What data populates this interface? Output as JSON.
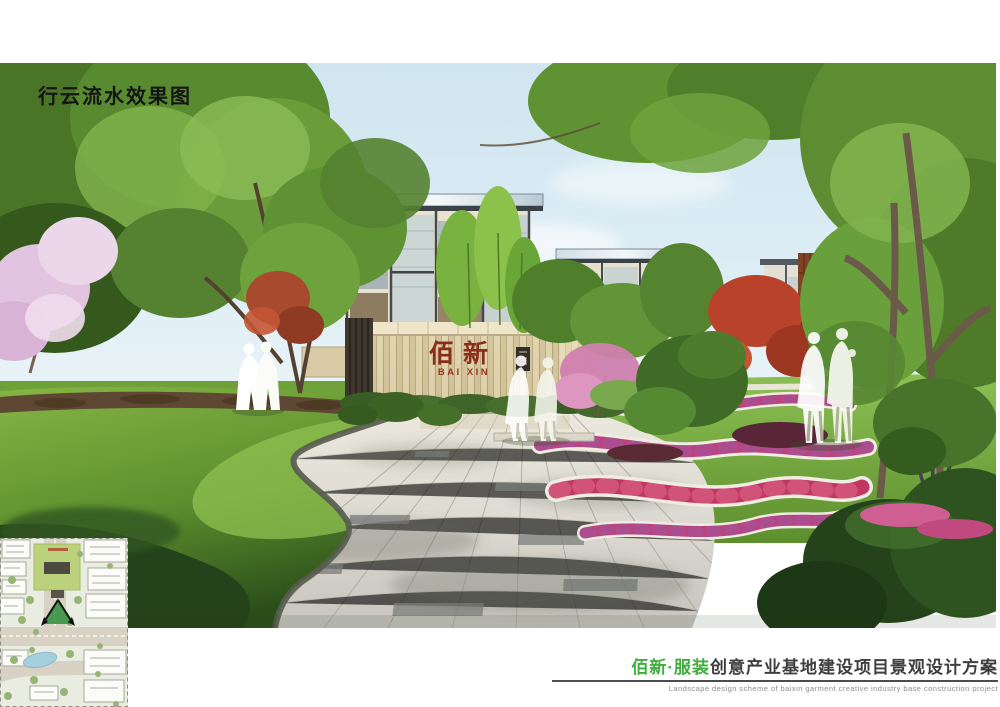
{
  "title": {
    "text": "行云流水效果图"
  },
  "rendering": {
    "description": "entry landscape perspective rendering",
    "gate_sign": {
      "chinese": "佰新",
      "latin": "BAI XIN"
    },
    "colors": {
      "sign_red": "#8a2d1b",
      "stone_beige": "#ddd0ab",
      "flower_pink": "#c2407a",
      "lawn_green": "#7db344",
      "sky_blue": "#d8eaf3"
    }
  },
  "inset": {
    "label": "site-plan key map"
  },
  "caption": {
    "project_highlight": "佰新·服装",
    "project_rest": "创意产业基地建设项目景观设计方案",
    "subtitle_en": "Landscape  design  scheme  of  baixin  garment  creative  industry  base  construction  project",
    "highlight_color": "#3fae3c",
    "text_color": "#3f3f3f"
  }
}
